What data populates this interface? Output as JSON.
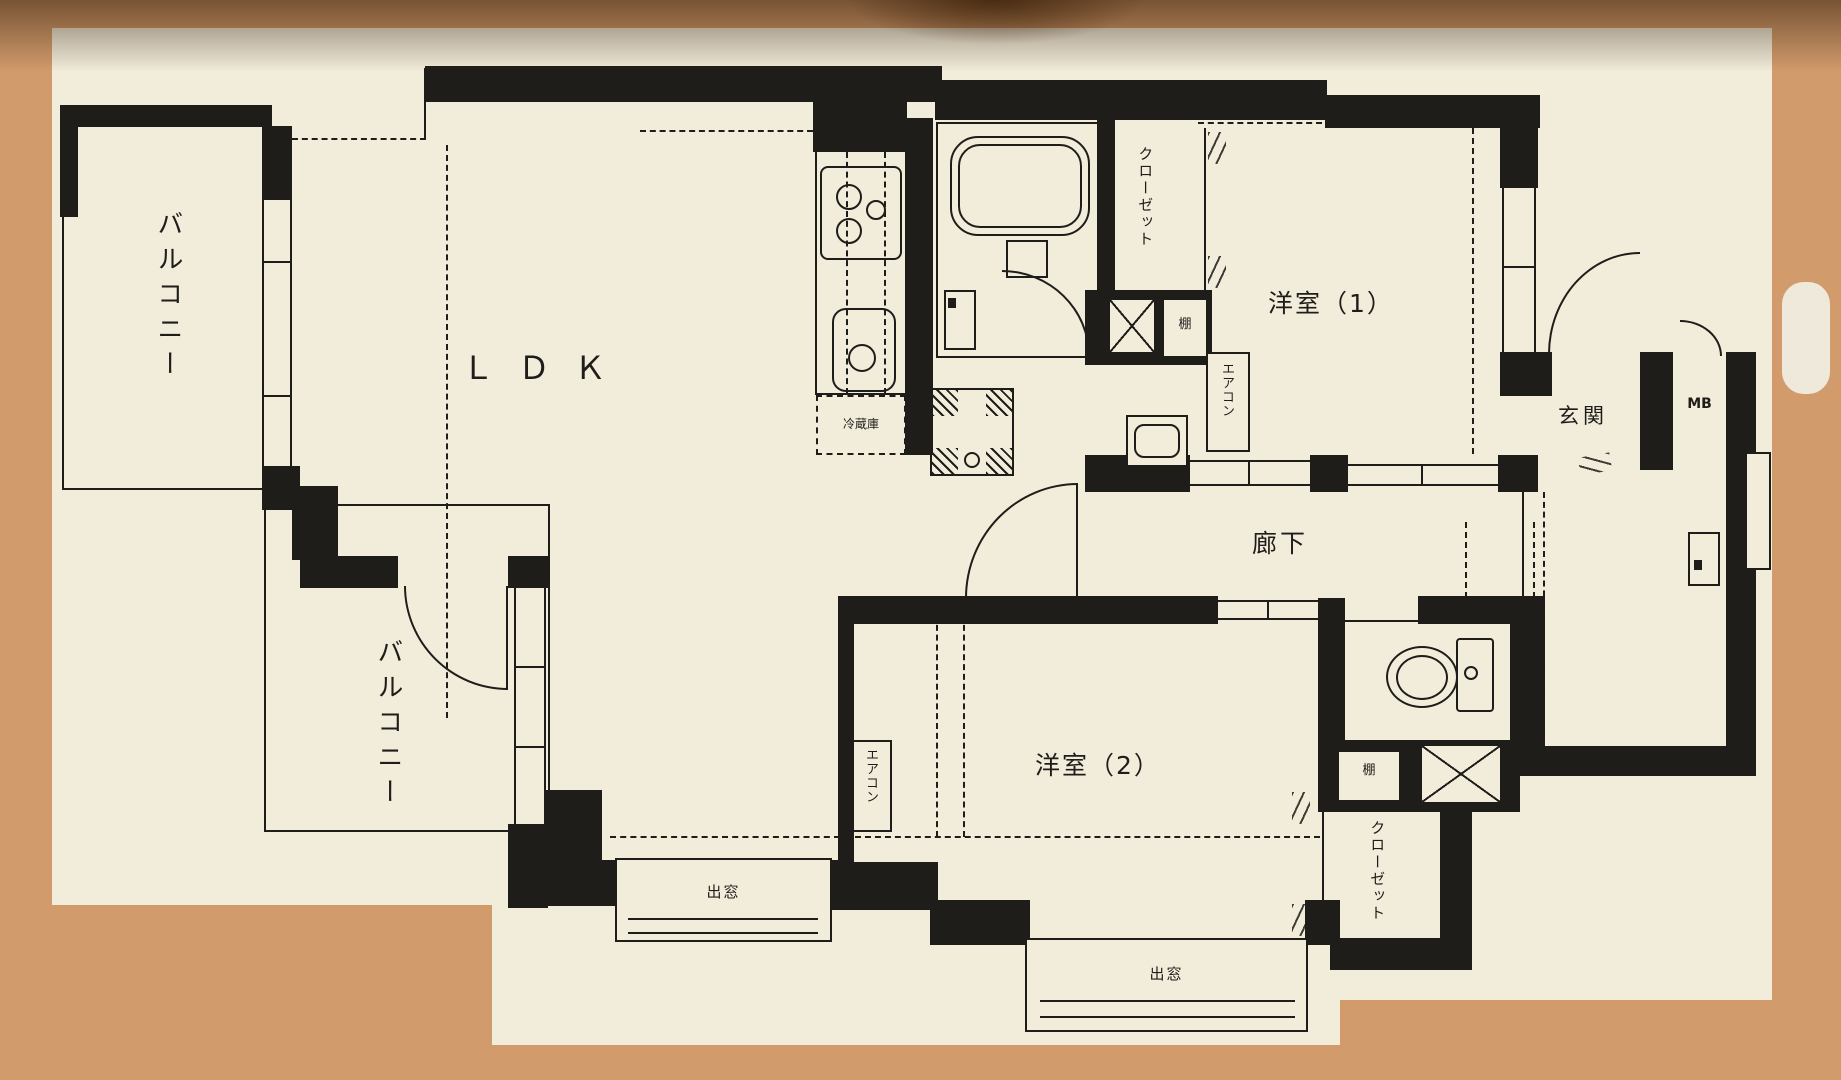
{
  "photo": {
    "wall_color": "#d29b6c",
    "paper_color": "#f2ecdb",
    "ink_color": "#1f1d1a"
  },
  "floorplan": {
    "labels": {
      "balcony1": "バルコニー",
      "balcony2": "バルコニー",
      "ldk": "ＬＤＫ",
      "refrigerator": "冷蔵庫",
      "bedroom1": "洋室（1）",
      "bedroom2": "洋室（2）",
      "hallway": "廊下",
      "entrance": "玄関",
      "meter_box": "MB",
      "closet1": "クローゼット",
      "closet2": "クローゼット",
      "aircon1": "エアコン",
      "aircon2": "エアコン",
      "shelf1": "棚",
      "shelf2": "棚",
      "bay_window1": "出窓",
      "bay_window2": "出窓"
    }
  }
}
